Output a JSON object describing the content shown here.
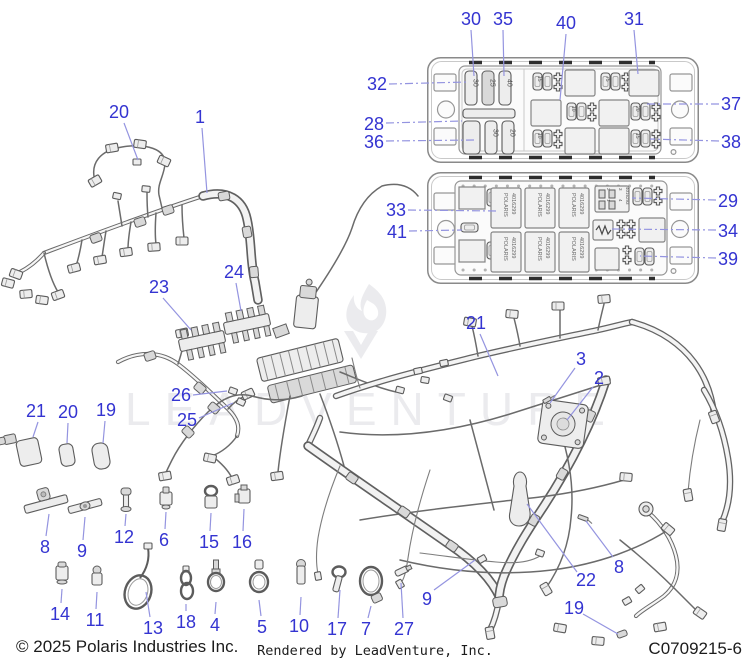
{
  "colors": {
    "callout_blue": "#3434d1",
    "leader_blue": "#9494e0",
    "wm_gray": "#ebebee"
  },
  "watermark": {
    "text": "LEADVENTURE"
  },
  "footer": {
    "copyright": "© 2025 Polaris Industries Inc.",
    "rendered_by": "Rendered by LeadVenture, Inc.",
    "drawing_number": "C0709215-6"
  },
  "fusebox_top": {
    "big_fuses": [
      "30",
      "25",
      "40"
    ],
    "big_fuses_row2": [
      "30",
      "20"
    ],
    "mini_fuses": [
      "15",
      "75",
      "10",
      "20",
      "10",
      "15"
    ]
  },
  "fusebox_bottom": {
    "relay_brand": "POLARIS",
    "relay_part": "4016299",
    "aux_part": "4016293",
    "pins": [
      "2",
      "1",
      "3",
      "4"
    ]
  },
  "callouts": {
    "k1": "1",
    "k2": "2",
    "k3": "3",
    "k4": "4",
    "k5": "5",
    "k6": "6",
    "k7": "7",
    "k8a": "8",
    "k8b": "8",
    "k9a": "9",
    "k9b": "9",
    "k10": "10",
    "k11": "11",
    "k12": "12",
    "k13": "13",
    "k14": "14",
    "k15": "15",
    "k16": "16",
    "k17": "17",
    "k18": "18",
    "k19a": "19",
    "k19b": "19",
    "k20a": "20",
    "k20b": "20",
    "k21a": "21",
    "k21b": "21",
    "k22": "22",
    "k23": "23",
    "k24": "24",
    "k25": "25",
    "k26": "26",
    "k27": "27",
    "k28": "28",
    "k29": "29",
    "k30": "30",
    "k31": "31",
    "k32": "32",
    "k33": "33",
    "k34": "34",
    "k35": "35",
    "k36": "36",
    "k37": "37",
    "k38": "38",
    "k39": "39",
    "k40": "40",
    "k41": "41"
  }
}
